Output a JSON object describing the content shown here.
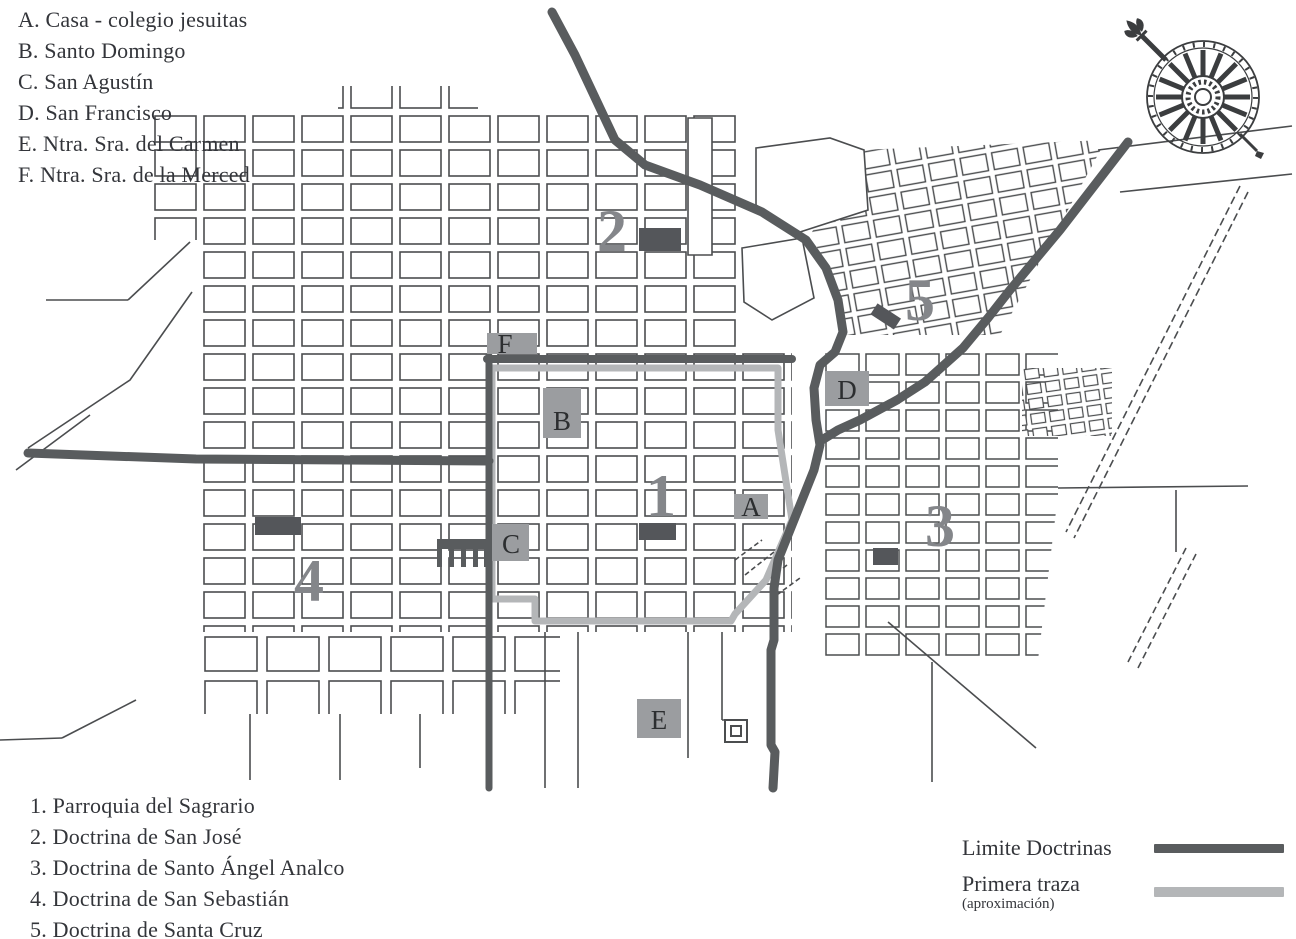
{
  "figure": {
    "type": "historical-city-map",
    "description_visible_text_only": true
  },
  "legend_churches": {
    "items": [
      "A. Casa - colegio jesuitas",
      "B. Santo Domingo",
      "C. San Agustín",
      "D. San Francisco",
      "E. Ntra. Sra. del Carmen",
      "F. Ntra. Sra. de la Merced"
    ]
  },
  "legend_doctrinas": {
    "items": [
      "1. Parroquia del Sagrario",
      "2. Doctrina de San José",
      "3. Doctrina de Santo Ángel Analco",
      "4. Doctrina de San Sebastián",
      "5. Doctrina de Santa Cruz"
    ]
  },
  "legend_lines": {
    "limite_label": "Limite Doctrinas",
    "primera_label": "Primera traza",
    "primera_sublabel": "(aproximación)",
    "limite_color": "#595c5e",
    "primera_color": "#b4b6b8"
  },
  "map": {
    "letter_markers": [
      {
        "label": "A"
      },
      {
        "label": "B"
      },
      {
        "label": "C"
      },
      {
        "label": "D"
      },
      {
        "label": "E"
      },
      {
        "label": "F"
      }
    ],
    "number_markers": [
      {
        "label": "1"
      },
      {
        "label": "2"
      },
      {
        "label": "3"
      },
      {
        "label": "4"
      },
      {
        "label": "5"
      }
    ],
    "icons": {
      "compass": "compass-rose-icon"
    },
    "colors": {
      "street": "#4b4d4f",
      "limite_doctrinas": "#595c5e",
      "primera_traza": "#b4b6b8",
      "site_marker": "#54565a",
      "letter_square": "#9b9da0",
      "numeral": "#84868a"
    }
  }
}
